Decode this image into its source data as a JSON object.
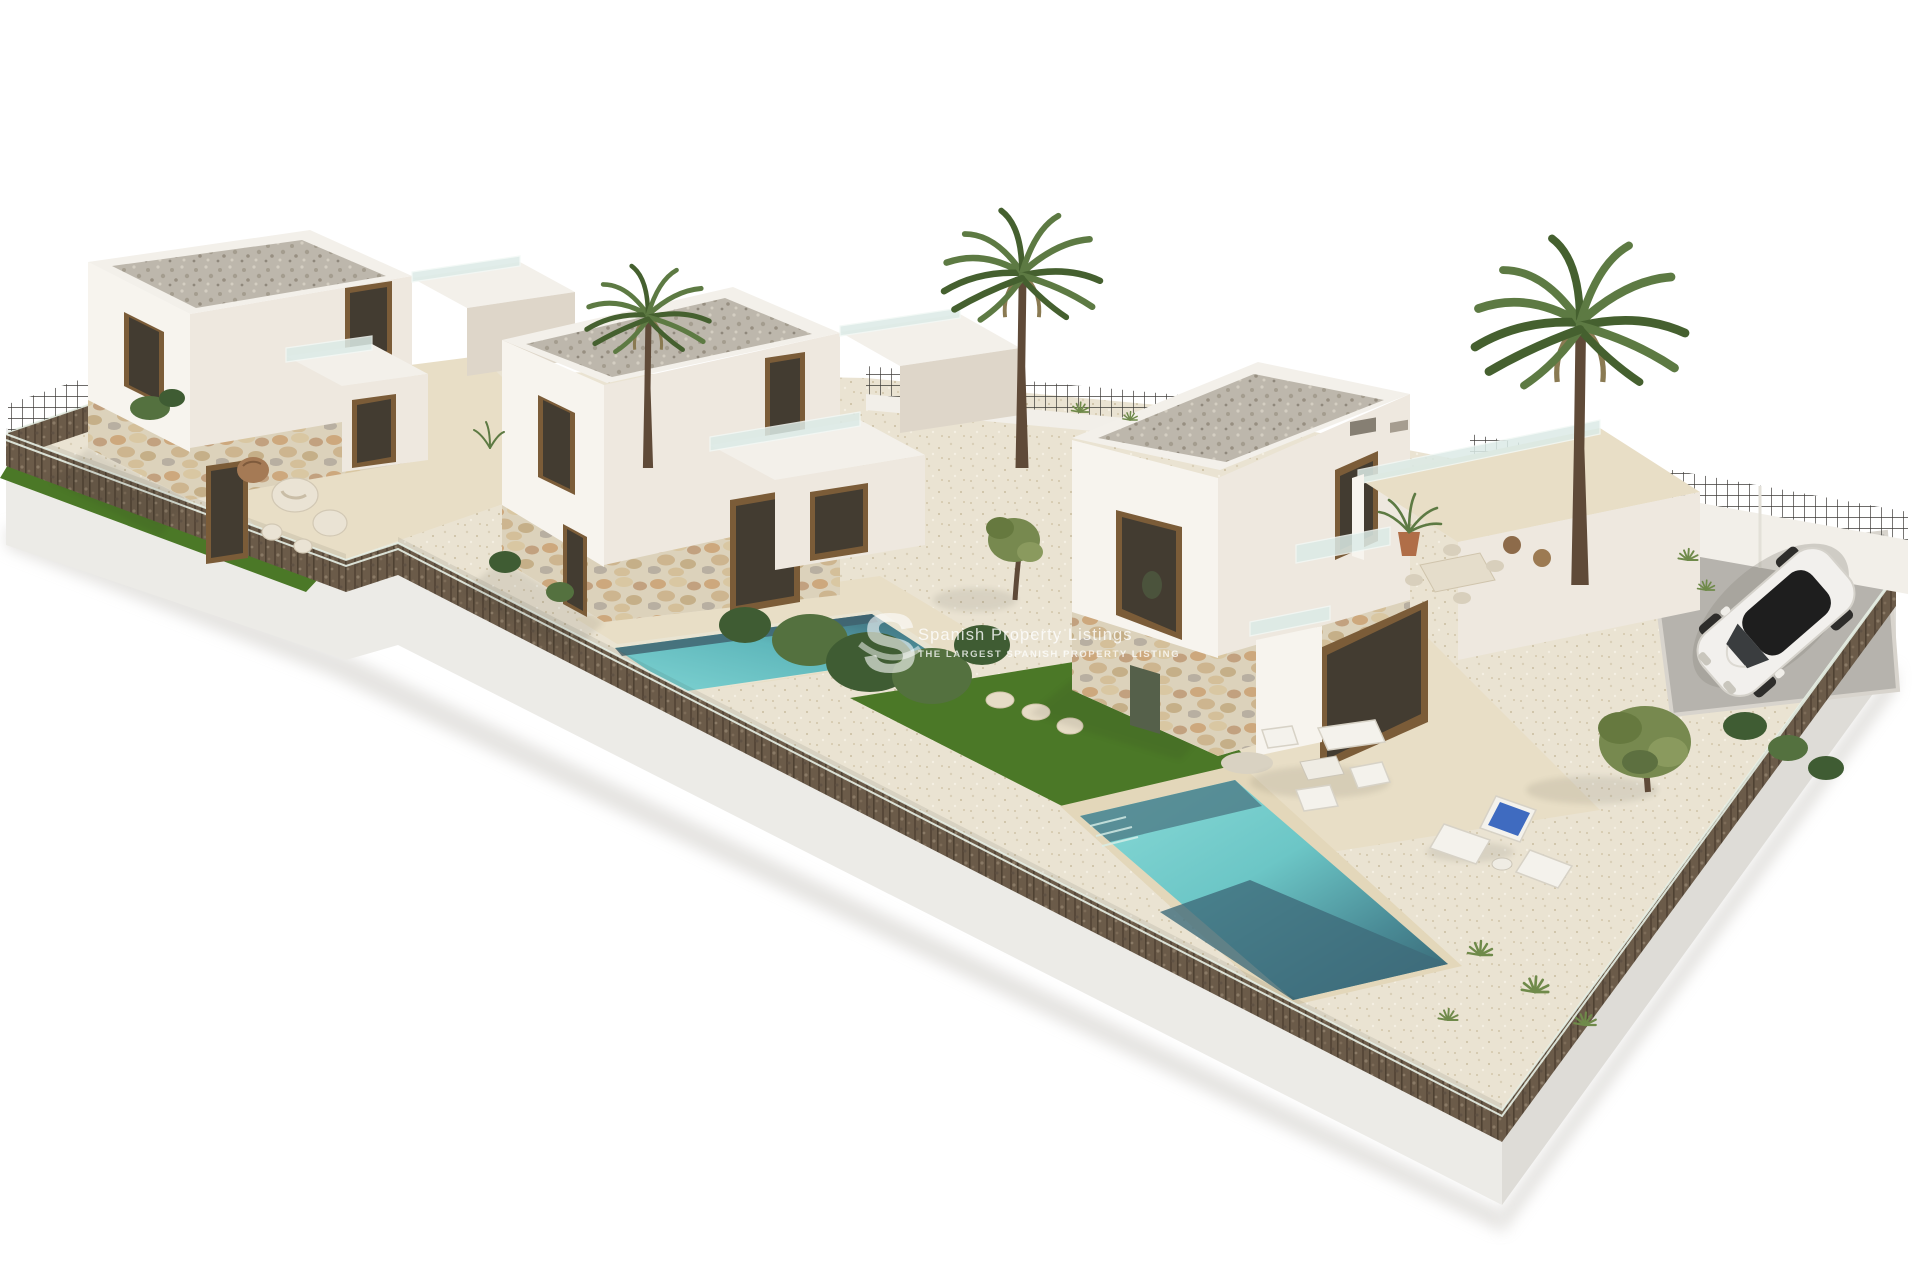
{
  "scene": {
    "background": "#ffffff",
    "view": "aerial-3d-architectural-render",
    "subject": "three modern white villas with private pools and gardens"
  },
  "watermark": {
    "logo_letter": "S",
    "title": "Spanish Property Listings",
    "subtitle": "THE LARGEST SPANISH PROPERTY LISTING"
  },
  "palette": {
    "bg": "#ffffff",
    "wall-white": "#f7f4ee",
    "wall-shade": "#eee8df",
    "wall-dim": "#ded6c9",
    "roof-border": "#f3f0ea",
    "roof-gravel": "#bdb7ac",
    "terrace-beige": "#e8dec6",
    "lawn-green": "#4b7827",
    "pool-light": "#7fd4d3",
    "pool-deep": "#3d6a77",
    "gabion-brown": "#6b5b49",
    "plinth-light": "#ecebe7",
    "plinth-shade": "#dedcd7",
    "fence-dark": "#3d3c38",
    "glass-blue": "#dcebe7",
    "glass-edge": "#f2f8f5",
    "rail-light": "#e7efe5",
    "window-frame": "#7b5c38",
    "window-glass": "#433c31",
    "palm-green": "#5d7a43",
    "palm-dark": "#45602f",
    "trunk-brown": "#5f4a38",
    "bush-dark": "#3f5c33",
    "bush-light": "#54713f",
    "olive-green": "#77894f",
    "agave": "#6f8a4a",
    "car-white": "#f2f0ed",
    "pad-gray": "#b6b3ad",
    "lounger-blue": "#3f6bc0",
    "wm-color": "#ffffff"
  },
  "objects": {
    "villas": [
      "villa-left",
      "villa-middle",
      "villa-right"
    ],
    "pools": [
      "lap-pool-middle",
      "main-pool-right"
    ],
    "trees": [
      "palm-left",
      "palm-center",
      "palm-right",
      "olive-yard",
      "olive-courtyard"
    ],
    "vehicle": "white-suv",
    "furniture": [
      "outdoor-sofa-set",
      "sun-loungers",
      "roof-terrace-dining-set",
      "decorative-stones"
    ]
  }
}
